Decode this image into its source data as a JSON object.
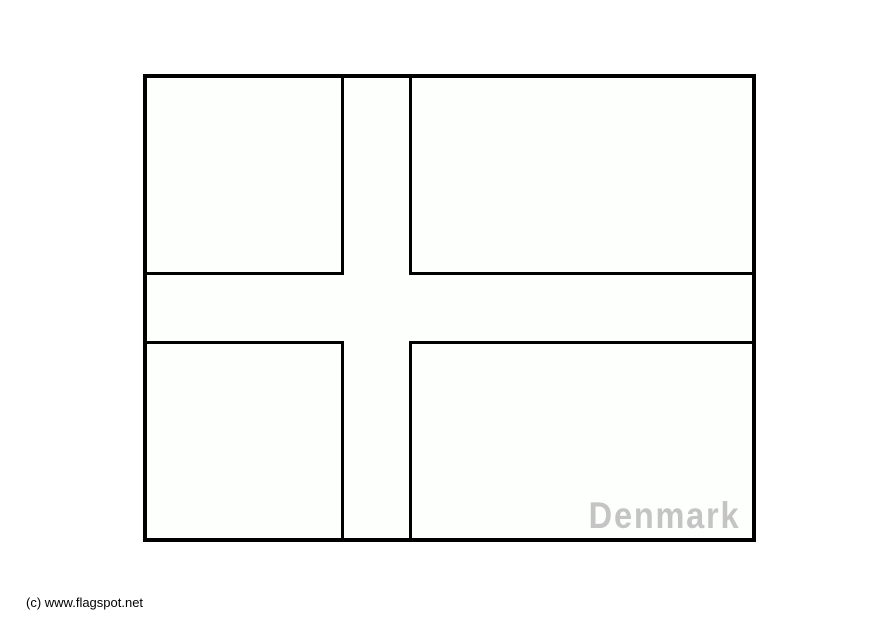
{
  "figure": {
    "country": "Denmark",
    "label": "Denmark",
    "label_color": "#c4c4c4",
    "outline_color": "#000000",
    "fill_color": "#fdfffc"
  },
  "footer": {
    "copyright": "(c) www.flagspot.net"
  }
}
